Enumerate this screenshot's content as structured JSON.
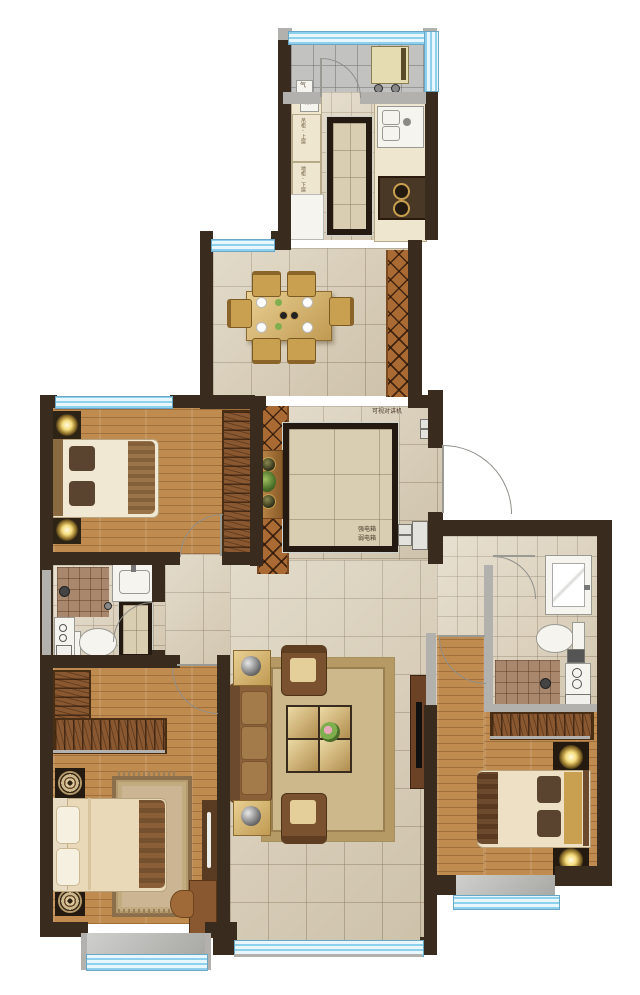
{
  "labels": {
    "gas_meter": "气",
    "water_heater": "热",
    "cabinet_label_upper": "吊柜-上层",
    "cabinet_label_lower": "地柜-下层",
    "intercom": "可视对讲机",
    "strong_electric_box": "强电箱",
    "weak_electric_box": "弱电箱"
  },
  "colors": {
    "wall": "#3a2b1f",
    "partition_gray": "#b3b1ad",
    "window_glass": "#e8f7fd",
    "window_line": "#8fd0ec",
    "marble_floor": "#d8cdb6",
    "wood_floor": "#c08b4f",
    "walkway_parquet": "#a96a33",
    "shower_tile": "#a8876d",
    "counter": "#efe6cf",
    "furniture_wood": "#8a5830",
    "upholstery_gold": "#d9bd7e",
    "lamp_glow": "#f6dd7e"
  }
}
